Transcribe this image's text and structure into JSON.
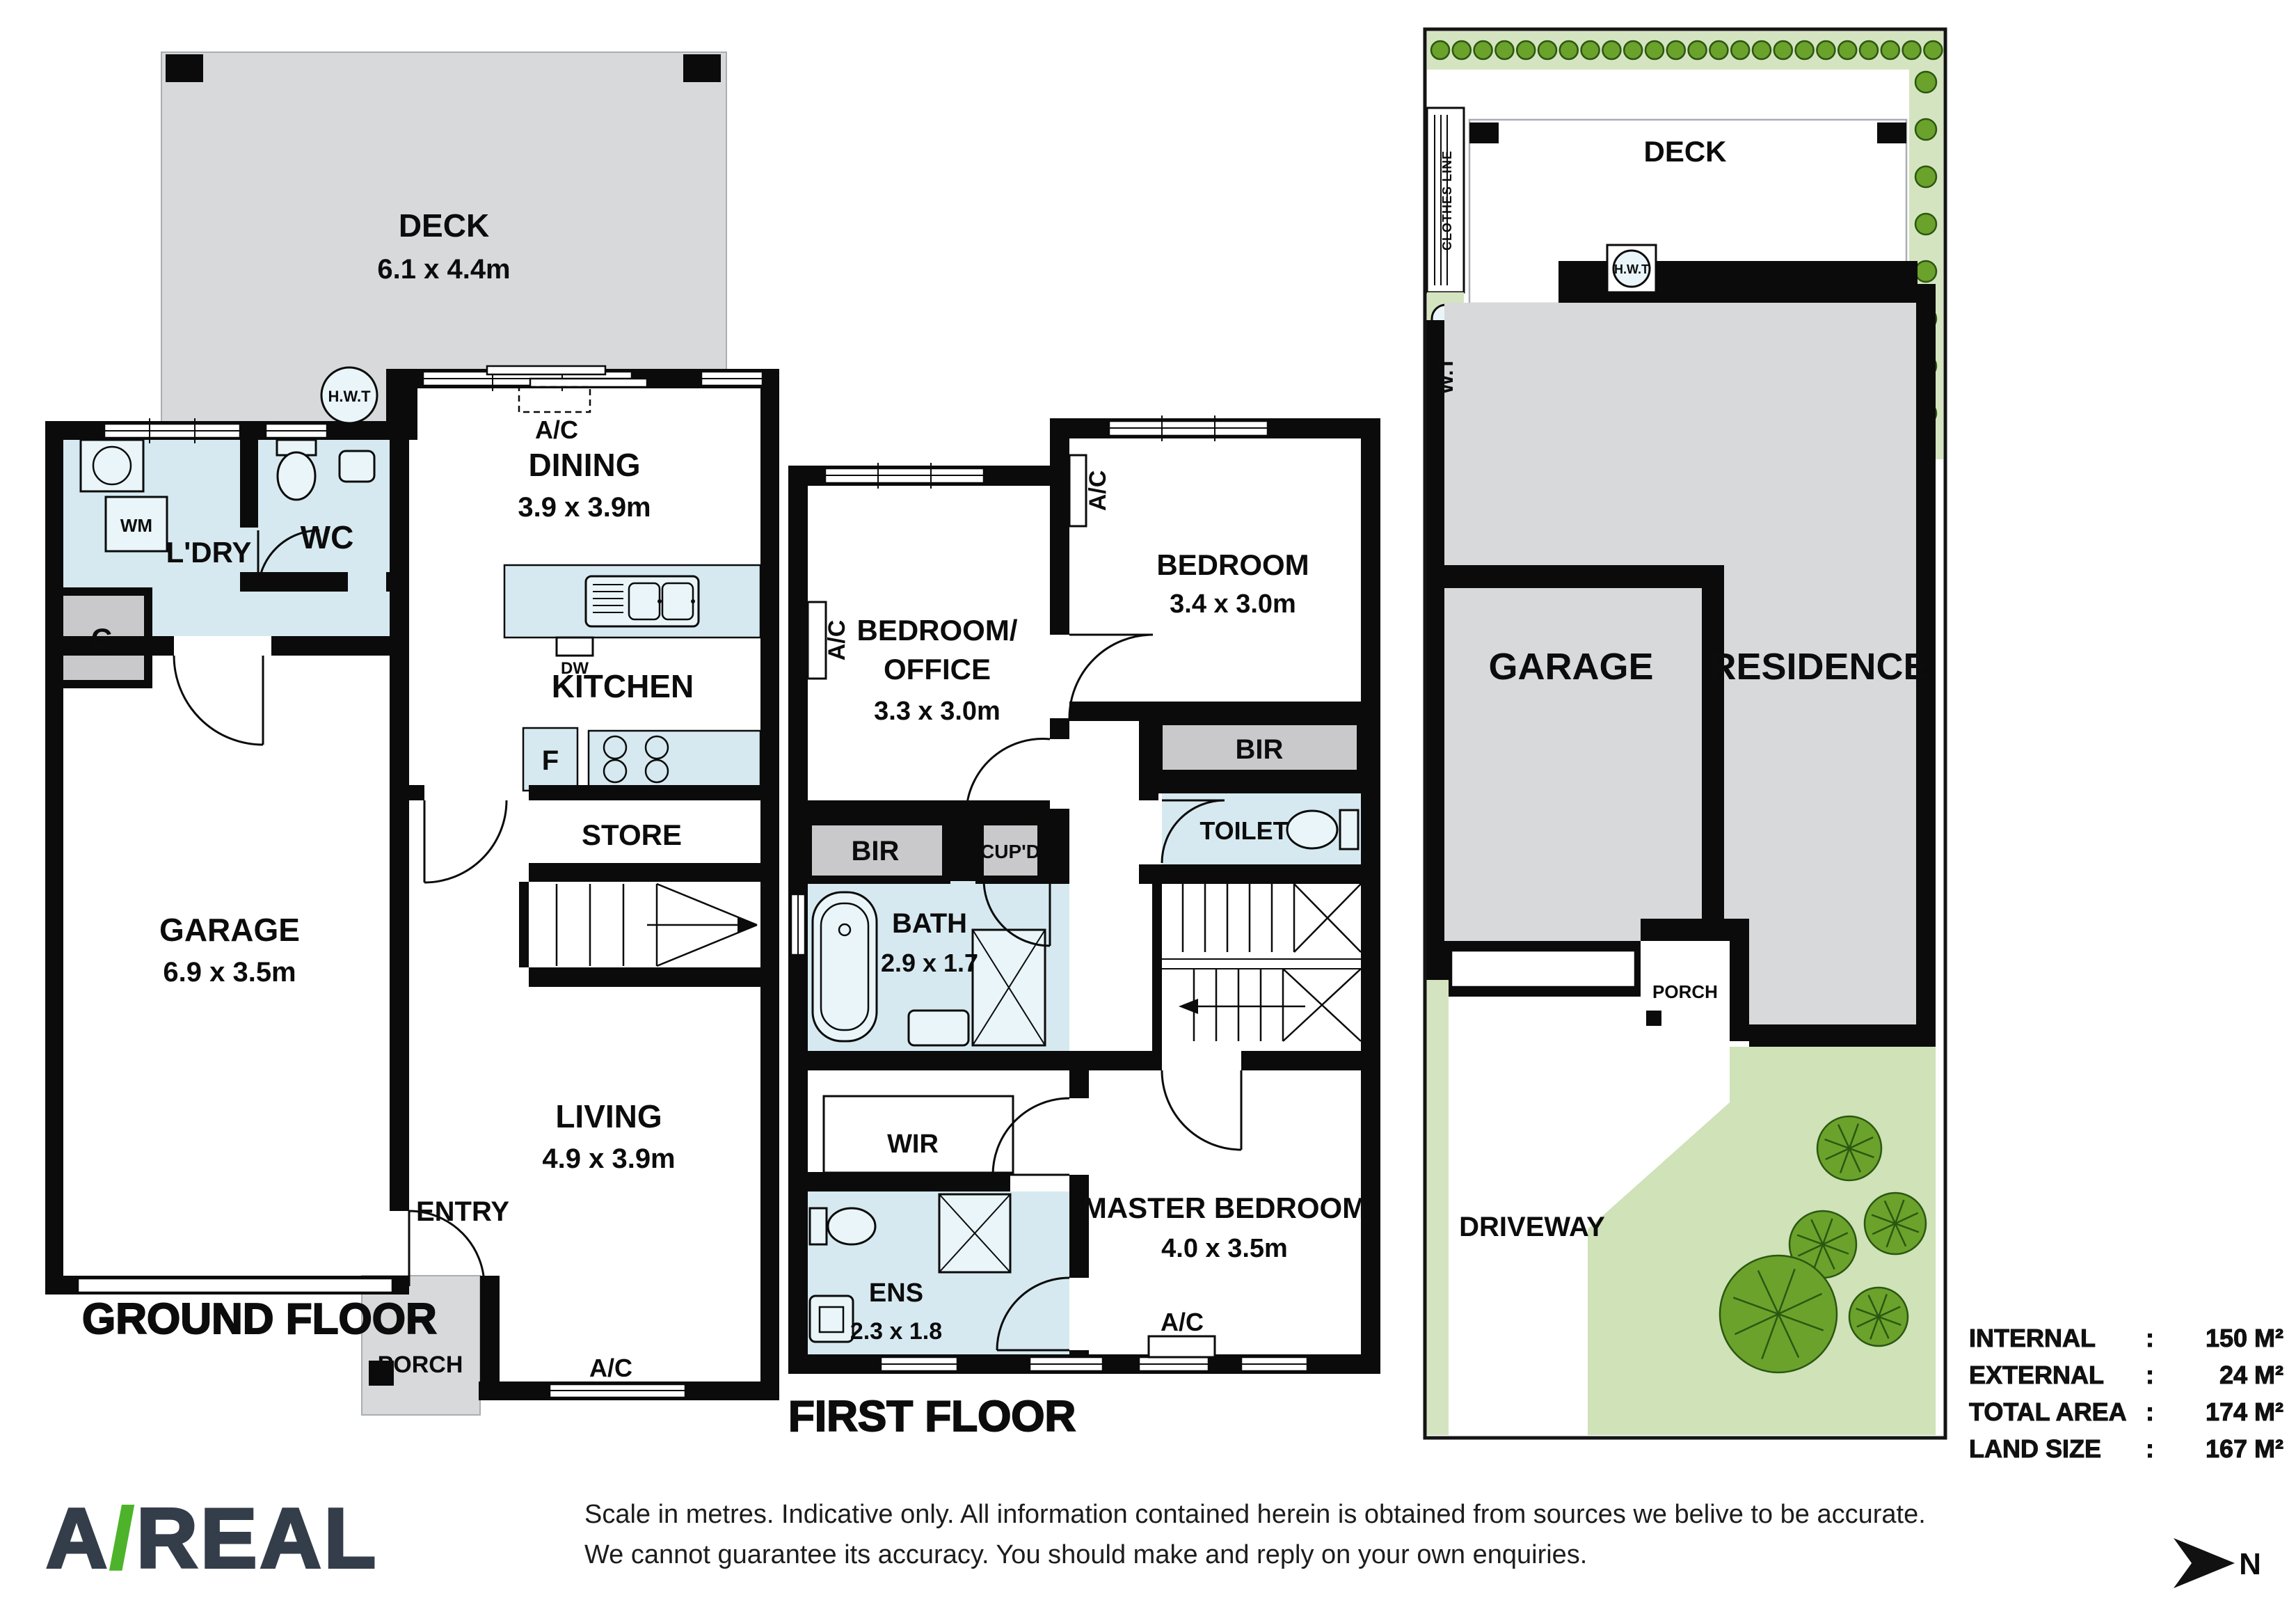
{
  "colors": {
    "wall": "#0b0b0b",
    "wet": "#d6e9f0",
    "deckgray": "#d8d9db",
    "robe": "#c9c9cb",
    "hedge": "#d5e4c0",
    "lawn": "#cfe2b8",
    "tree": "#6aa22c",
    "logodark": "#343d4a",
    "logogreen": "#4db32a"
  },
  "ground_floor": {
    "title": "GROUND FLOOR",
    "deck": {
      "name": "DECK",
      "dims": "6.1 x 4.4m"
    },
    "hwt": "H.W.T",
    "laundry": "L'DRY",
    "wm": "WM",
    "wc": "WC",
    "cupboard": "C",
    "ac_top": "A/C",
    "dining": {
      "name": "DINING",
      "dims": "3.9 x 3.9m"
    },
    "dw": "DW",
    "kitchen": "KITCHEN",
    "fridge": "F",
    "store": "STORE",
    "garage": {
      "name": "GARAGE",
      "dims": "6.9 x 3.5m"
    },
    "living": {
      "name": "LIVING",
      "dims": "4.9 x 3.9m"
    },
    "entry": "ENTRY",
    "porch": "PORCH",
    "ac_bottom": "A/C"
  },
  "first_floor": {
    "title": "FIRST FLOOR",
    "ac_left": "A/C",
    "bedroom_office": {
      "line1": "BEDROOM/",
      "line2": "OFFICE",
      "dims": "3.3 x 3.0m"
    },
    "ac_right": "A/C",
    "bedroom": {
      "name": "BEDROOM",
      "dims": "3.4 x 3.0m"
    },
    "bir_left": "BIR",
    "bir_right": "BIR",
    "cupd": "CUP'D",
    "toilet": "TOILET",
    "bath": {
      "name": "BATH",
      "dims": "2.9 x 1.7"
    },
    "wir": "WIR",
    "ens": {
      "name": "ENS",
      "dims": "2.3 x 1.8"
    },
    "master": {
      "name": "MASTER BEDROOM",
      "dims": "4.0 x 3.5m"
    },
    "ac_bottom": "A/C"
  },
  "site_plan": {
    "clothes_line": "CLOTHES LINE",
    "wt": "W.T",
    "deck": "DECK",
    "hwt": "H.W.T",
    "garage": "GARAGE",
    "residence": "RESIDENCE",
    "porch": "PORCH",
    "driveway": "DRIVEWAY"
  },
  "summary": {
    "separator": ":",
    "rows": [
      {
        "label": "INTERNAL",
        "value": "150 M²"
      },
      {
        "label": "EXTERNAL",
        "value": "24 M²"
      },
      {
        "label": "TOTAL AREA",
        "value": "174 M²"
      },
      {
        "label": "LAND SIZE",
        "value": "167 M²"
      }
    ]
  },
  "logo": {
    "prefix": "A",
    "slash": "/",
    "name": "REAL"
  },
  "disclaimer": {
    "line1": "Scale in metres. Indicative only. All information contained herein is obtained from sources we belive to be accurate.",
    "line2": "We cannot guarantee its accuracy. You should make and reply on your own enquiries."
  },
  "north": {
    "label": "N"
  }
}
